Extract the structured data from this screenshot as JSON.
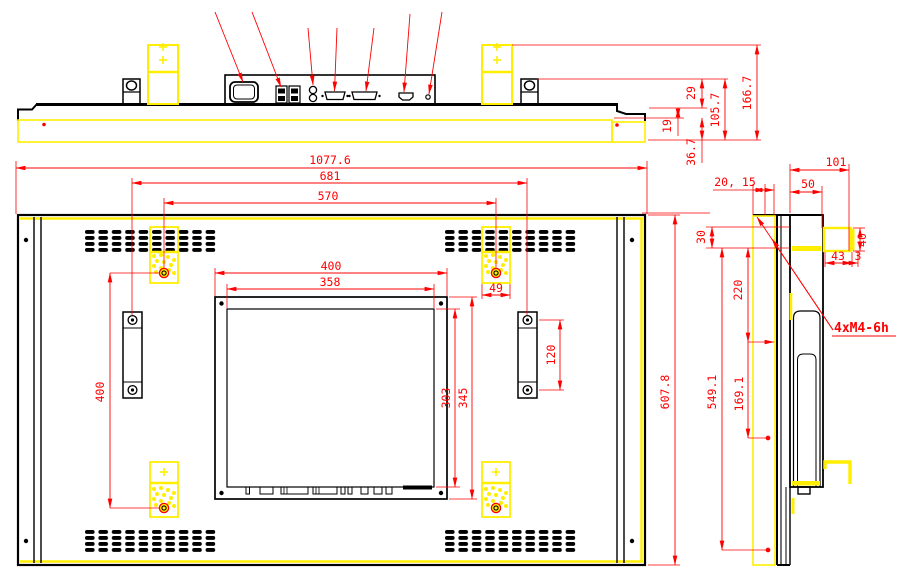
{
  "drawing": {
    "kind": "outline-dimension-drawing",
    "views": [
      "top-view",
      "rear-view",
      "side-view"
    ]
  },
  "top_view": {
    "dims": {
      "d29": "29",
      "d105_7": "105.7",
      "d166_7": "166.7",
      "d19": "19",
      "d36_7": "36.7"
    }
  },
  "rear_view": {
    "dims": {
      "width_overall": "1077.6",
      "width_681": "681",
      "width_570": "570",
      "width_400": "400",
      "width_358": "358",
      "width_49": "49",
      "height_120": "120",
      "height_303": "303",
      "height_345": "345",
      "height_400": "400",
      "height_overall": "607.8"
    }
  },
  "side_view": {
    "dims": {
      "d101": "101",
      "d50": "50",
      "d20_15": "20, 15",
      "d30": "30",
      "d220": "220",
      "d43": "43",
      "d3": "3",
      "d40": "40",
      "d549_1": "549.1",
      "d169_1": "169.1"
    },
    "mount_thread_label": "4xM4-6h"
  },
  "colors": {
    "dimension_red": "#fe0000",
    "highlight_yellow": "#ffee00",
    "outline_black": "#000000",
    "background": "#ffffff"
  }
}
